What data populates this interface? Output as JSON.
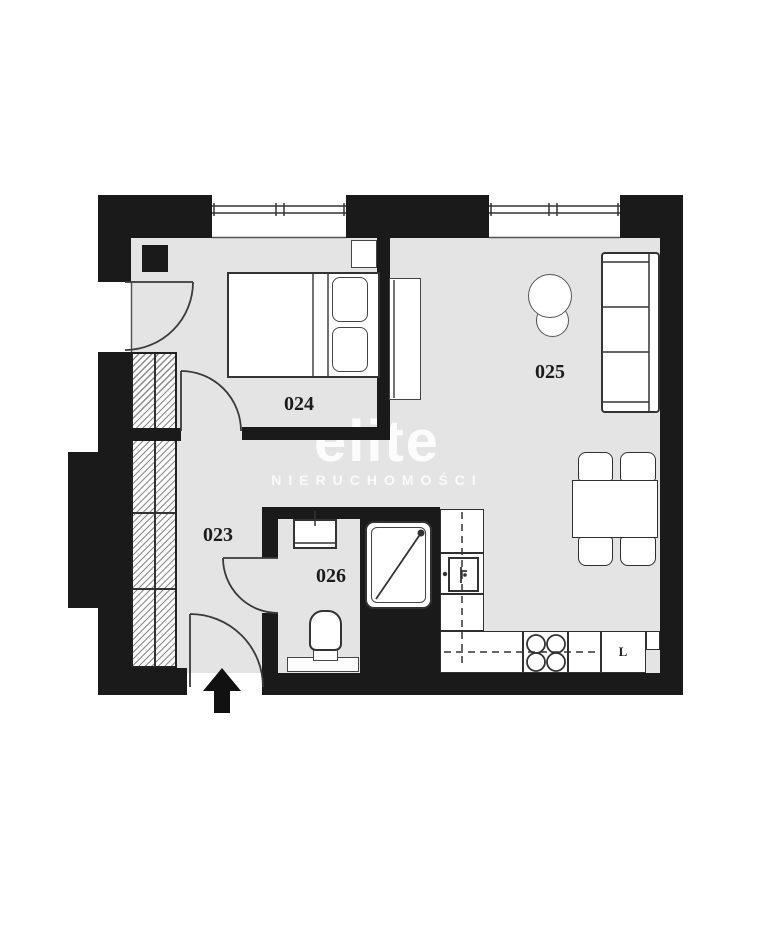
{
  "floorplan": {
    "rooms": [
      {
        "label": "023"
      },
      {
        "label": "024"
      },
      {
        "label": "025"
      },
      {
        "label": "026"
      }
    ],
    "kitchen": {
      "appliance_label": "L"
    },
    "watermark": {
      "brand": "elite",
      "subtitle": "NIERUCHOMOŚCI"
    },
    "colors": {
      "wall": "#1a1a1a",
      "floor": "#e4e4e5",
      "outline": "#333333"
    }
  }
}
